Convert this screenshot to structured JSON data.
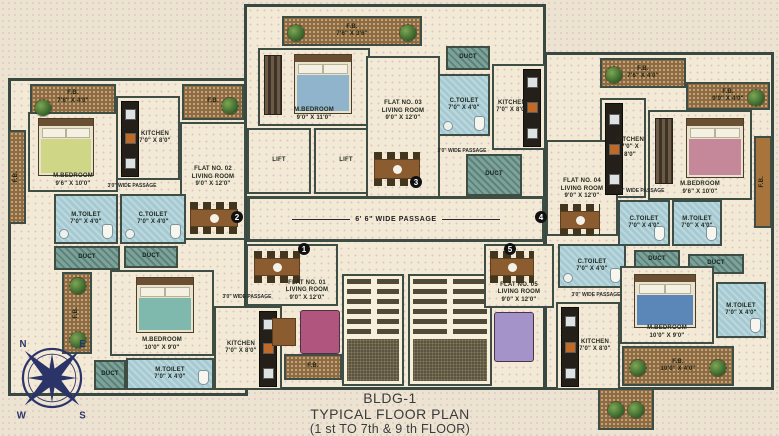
{
  "title": {
    "building": "BLDG-1",
    "plan": "TYPICAL FLOOR PLAN",
    "floors": "(1 st TO 7th & 9 th FLOOR)"
  },
  "corridor": "6' 6\" WIDE PASSAGE",
  "lift": "LIFT",
  "duct": "DUCT",
  "passage_small": "3'0\" WIDE PASSAGE",
  "flats": {
    "f1": {
      "no": "FLAT NO. 01",
      "type": "LIVING ROOM",
      "dims": "9'0\" X 12'0\"",
      "marker": "1"
    },
    "f2": {
      "no": "FLAT NO. 02",
      "type": "LIVING ROOM",
      "dims": "9'0\" X 12'0\"",
      "marker": "2"
    },
    "f3": {
      "no": "FLAT NO. 03",
      "type": "LIVING ROOM",
      "dims": "9'0\" X 12'0\"",
      "marker": "3"
    },
    "f4": {
      "no": "FLAT NO. 04",
      "type": "LIVING ROOM",
      "dims": "9'0\" X 12'0\"",
      "marker": "4"
    },
    "f5": {
      "no": "FLAT NO. 05",
      "type": "LIVING ROOM",
      "dims": "9'0\" X 12'0\"",
      "marker": "5"
    }
  },
  "rooms": {
    "mbed_f2": {
      "name": "M.BEDROOM",
      "dims": "9'6\" X 10'0\""
    },
    "mbed_top": {
      "name": "M.BEDROOM",
      "dims": "9'0\" X 11'0\""
    },
    "mbed_f4": {
      "name": "M.BEDROOM",
      "dims": "9'6\" X 10'0\""
    },
    "mbed_f1": {
      "name": "M.BEDROOM",
      "dims": "10'0\" X 9'0\""
    },
    "mbed_f5": {
      "name": "M.BEDROOM",
      "dims": "10'0\" X 9'0\""
    },
    "kitchen": {
      "name": "KITCHEN",
      "dims": "7'0\" X 8'0\""
    },
    "mtoilet": {
      "name": "M.TOILET",
      "dims": "7'0\" X 4'0\""
    },
    "ctoilet": {
      "name": "C.TOILET",
      "dims": "7'0\" X 4'0\""
    }
  },
  "flower_beds": {
    "fb_tl": {
      "name": "F.B.",
      "dims": "7'6\" X 4'0\""
    },
    "fb_tl2": {
      "name": "F.B.",
      "dims": ""
    },
    "fb_tc": {
      "name": "F.B.",
      "dims": "7'6\" X 3'6\""
    },
    "fb_tr1": {
      "name": "F.B.",
      "dims": "7'6\" X 4'0\""
    },
    "fb_tr2": {
      "name": "F.B.",
      "dims": "9'0\" X 4'0\""
    },
    "fb_left": {
      "name": "F.B.",
      "dims": ""
    },
    "fb_right": {
      "name": "F.B.",
      "dims": ""
    },
    "fb_bl": {
      "name": "F.B.",
      "dims": "9'0\" X 4'0\""
    },
    "fb_b1": {
      "name": "F.B.",
      "dims": ""
    },
    "fb_br": {
      "name": "F.B.",
      "dims": "10'0\" X 4'0\""
    }
  },
  "compass": {
    "n": "N",
    "e": "E",
    "s": "S",
    "w": "W"
  },
  "colors": {
    "walls": "#3f4e44",
    "floor": "#f2ead5",
    "toilet_blue": "#a6cad2",
    "duct_teal": "#7ca39a",
    "flower_bed_brown": "#8d6b44",
    "compass_navy": "#2b3468"
  }
}
